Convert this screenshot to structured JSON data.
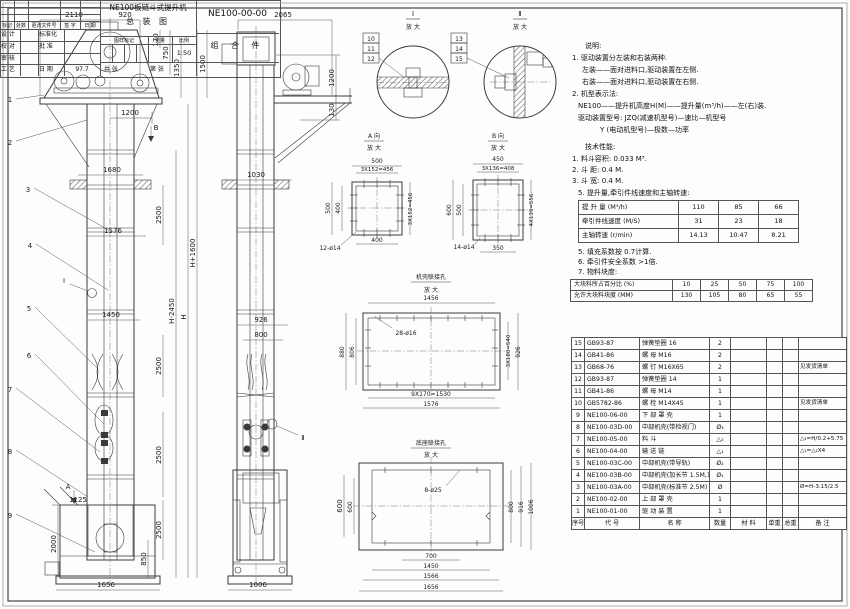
{
  "notes": {
    "heading": "说明:",
    "l1": "1. 驱动装置分左装和右装两种.",
    "l2": "左装——面对进料口,驱动装置在左侧.",
    "l3": "右装——面对进料口,驱动装置在右侧.",
    "l4": "2. 机型表示法:",
    "l5": "NE100——提升机高度H(M)——提升量(m³/h)——左(右)装.",
    "l6": "驱动装置型号: JZQ(减速机型号)—速比—机型号",
    "l7": "Y (电动机型号)—极数—功率"
  },
  "tech": {
    "heading": "技术性能:",
    "l1": "1. 料斗容积: 0.033 M³.",
    "l2": "2. 斗    距: 0.4 M.",
    "l3": "3. 斗    宽: 0.4 M.",
    "l4": "5. 提升量,牵引件线速度和主轴转速:",
    "n5": "5. 填充系数按 0.7计算.",
    "n6": "6. 牵引件安全系数 >1倍.",
    "n7": "7. 物料块度:"
  },
  "speed_table": {
    "rows": [
      {
        "label": "提 升 量  (M³/h)",
        "v0": "110",
        "v1": "85",
        "v2": "66"
      },
      {
        "label": "牵引件线速度 (M/S)",
        "v0": "31",
        "v1": "23",
        "v2": "18"
      },
      {
        "label": "主轴转速 (r/min)",
        "v0": "14.13",
        "v1": "10.47",
        "v2": "8.21"
      }
    ]
  },
  "lump_table": {
    "rows": [
      {
        "label": "大块料所占百分比 (%)",
        "v0": "10",
        "v1": "25",
        "v2": "50",
        "v3": "75",
        "v4": "100"
      },
      {
        "label": "允许大块料块度 (MM)",
        "v0": "130",
        "v1": "105",
        "v2": "80",
        "v3": "65",
        "v4": "55"
      }
    ]
  },
  "bom": {
    "header": {
      "no": "序号",
      "code": "代  号",
      "name": "名  称",
      "qty": "数量",
      "mat": "材  料",
      "uw": "单重",
      "tw": "总重",
      "rem": "备  注"
    },
    "rows": [
      {
        "no": "15",
        "code": "GB93-87",
        "name": "弹簧垫圈  16",
        "qty": "2",
        "rem": ""
      },
      {
        "no": "14",
        "code": "GB41-86",
        "name": "螺 母  M16",
        "qty": "2",
        "rem": ""
      },
      {
        "no": "13",
        "code": "GB68-76",
        "name": "螺 钉  M16X65",
        "qty": "2",
        "rem": "见发货清单"
      },
      {
        "no": "12",
        "code": "GB93-87",
        "name": "弹簧垫圈  14",
        "qty": "1",
        "rem": ""
      },
      {
        "no": "11",
        "code": "GB41-86",
        "name": "螺 母  M14",
        "qty": "1",
        "rem": ""
      },
      {
        "no": "10",
        "code": "GB5782-86",
        "name": "螺 栓  M14X45",
        "qty": "1",
        "rem": "见发货清单"
      },
      {
        "no": "9",
        "code": "NE100-06-00",
        "name": "下 部 罩 壳",
        "qty": "1",
        "rem": ""
      },
      {
        "no": "8",
        "code": "NE100-03D-00",
        "name": "中部机壳(带检视门)",
        "qty": "Ø₃",
        "rem": ""
      },
      {
        "no": "7",
        "code": "NE100-05-00",
        "name": "料  斗",
        "qty": "△₂",
        "rem": "△₂=H/0.2+5.75"
      },
      {
        "no": "6",
        "code": "NE100-04-00",
        "name": "输 送 链",
        "qty": "△₁",
        "rem": "△₁=△₂X4"
      },
      {
        "no": "5",
        "code": "NE100-03C-00",
        "name": "中部机壳(带导轨)",
        "qty": "Ø₂",
        "rem": ""
      },
      {
        "no": "4",
        "code": "NE100-03B-00",
        "name": "中部机壳(加长节 1.5M,1M)",
        "qty": "Ø₁",
        "rem": ""
      },
      {
        "no": "3",
        "code": "NE100-03A-00",
        "name": "中部机壳(标准节 2.5M)",
        "qty": "Ø",
        "rem": "Ø=H-3.15/2.5"
      },
      {
        "no": "2",
        "code": "NE100-02-00",
        "name": "上 部 罩 壳",
        "qty": "1",
        "rem": ""
      },
      {
        "no": "1",
        "code": "NE100-01-00",
        "name": "驱 动 装 置",
        "qty": "1",
        "rem": ""
      }
    ]
  },
  "title_block": {
    "change_header": {
      "c1": "标记",
      "c2": "处数",
      "c3": "更改文件号",
      "c4": "签 字",
      "c5": "日 期"
    },
    "r1l": "设 计",
    "r1r": "标准化",
    "r2l": "校 对",
    "r2r": "批 准",
    "r3l": "审 核",
    "r4l": "工 艺",
    "r4r": "日 期",
    "r4v": "97.7",
    "title1": "NE100板链斗式提升机",
    "title2": "总  装  图",
    "code": "NE100-00-00",
    "part_type": "组 合 件",
    "stamp": {
      "s1": "图样标记",
      "s2": "重量",
      "s3": "比例",
      "scale": "1:50"
    },
    "sheet_total": "共  张",
    "sheet_no": "第  张"
  },
  "views": {
    "main": {
      "leaders": [
        "1",
        "2",
        "3",
        "4",
        "5",
        "6",
        "7",
        "8",
        "9"
      ],
      "dims": {
        "d2110": "2110",
        "d920": "920",
        "d170": "170",
        "d750": "750",
        "d1350": "1350",
        "d1500": "1500",
        "d1200": "1200",
        "vb": "B",
        "d1680": "1680",
        "d2500": "2500",
        "d1576": "1576",
        "dhp": "H+1600",
        "dhm": "H-2450",
        "dh": "H",
        "d1450": "1450",
        "mi": "Ⅰ",
        "d1125": "1125",
        "va": "A",
        "d2000": "2000",
        "d850": "850",
        "d1656": "1656"
      }
    },
    "side": {
      "dims": {
        "d2065": "2065",
        "d1200": "1200",
        "d130": "130",
        "d1030": "1030",
        "d926": "926",
        "d800": "800",
        "mii": "Ⅱ",
        "d600": "600",
        "d1006": "1006"
      }
    },
    "detail_i": {
      "label": "Ⅰ",
      "sub": "放 大",
      "p0": "10",
      "p1": "11",
      "p2": "12"
    },
    "detail_ii": {
      "label": "Ⅱ",
      "sub": "放 大",
      "p0": "13",
      "p1": "14",
      "p2": "15"
    },
    "view_a": {
      "label": "A 向",
      "sub": "放 大",
      "top": "500",
      "top2": "3X152=456",
      "left": "500",
      "left2": "400",
      "bottom": "400",
      "holes": "12-ø14",
      "right": "3X152=456"
    },
    "view_b": {
      "label": "B 向",
      "sub": "放 大",
      "top": "450",
      "top2": "3X136=408",
      "left": "600",
      "left2": "500",
      "bottom": "350",
      "holes": "14-ø14",
      "right": "4X139=556"
    },
    "casing_flange": {
      "label": "机壳联接孔",
      "sub": "放 大",
      "top": "1456",
      "holes": "28-ø16",
      "left": "880",
      "left2": "806",
      "right": "3X180=540",
      "right2": "926",
      "bottom": "9X170=1530",
      "bottom2": "1576"
    },
    "base_flange": {
      "label": "底座联接孔",
      "sub": "放 大",
      "holes": "8-ø25",
      "left": "600",
      "right1": "800",
      "right2": "916",
      "right3": "1006",
      "bottom1": "700",
      "bottom2": "1450",
      "bottom3": "1566",
      "bottom4": "1656"
    }
  }
}
